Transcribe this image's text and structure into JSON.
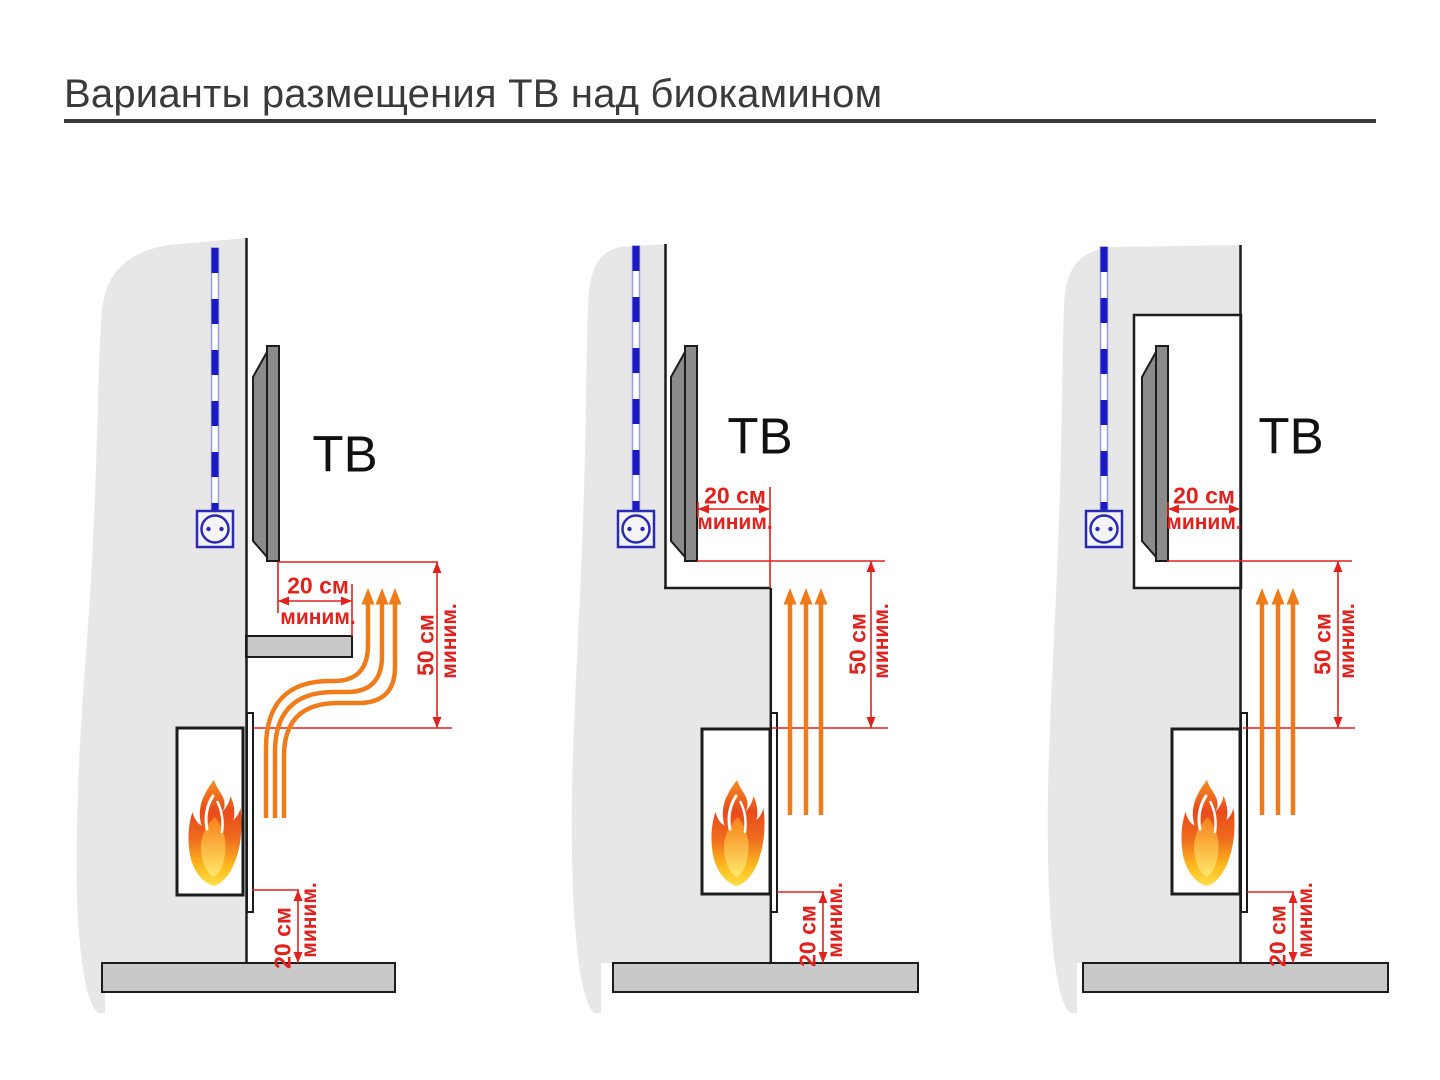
{
  "title": "Варианты размещения ТВ над биокамином",
  "colors": {
    "dimension_red": "#e2211c",
    "cable_blue": "#1b1bc4",
    "socket_blue": "#2a2ab4",
    "heat_orange": "#ee7c1b",
    "wall_gray": "#e7e7e7",
    "floor_gray": "#c9c9c9",
    "tv_gray": "#8b8b8b",
    "outline_black": "#1c1c1c",
    "title_gray": "#3a3a3a"
  },
  "icons": {
    "power_outlet": "outlet-circle-with-two-pins",
    "power_cable": "blue-dashed-conduit-line",
    "flame": "fire-gradient-teardrop",
    "heat_flow": "orange-upward-arrows"
  },
  "variants": [
    {
      "id": "tv-over-shelf",
      "tv_label": "ТВ",
      "clearance_front": {
        "value": "20 см",
        "qualifier": "миним."
      },
      "clearance_above": {
        "value": "50 см",
        "qualifier": "миним."
      },
      "clearance_floor": {
        "value": "20 см",
        "qualifier": "миним."
      }
    },
    {
      "id": "tv-on-recessed-wall",
      "tv_label": "ТВ",
      "clearance_front": {
        "value": "20 см",
        "qualifier": "миним."
      },
      "clearance_above": {
        "value": "50 см",
        "qualifier": "миним."
      },
      "clearance_floor": {
        "value": "20 см",
        "qualifier": "миним."
      }
    },
    {
      "id": "tv-in-niche",
      "tv_label": "ТВ",
      "clearance_front": {
        "value": "20 см",
        "qualifier": "миним."
      },
      "clearance_above": {
        "value": "50 см",
        "qualifier": "миним."
      },
      "clearance_floor": {
        "value": "20 см",
        "qualifier": "миним."
      }
    }
  ]
}
